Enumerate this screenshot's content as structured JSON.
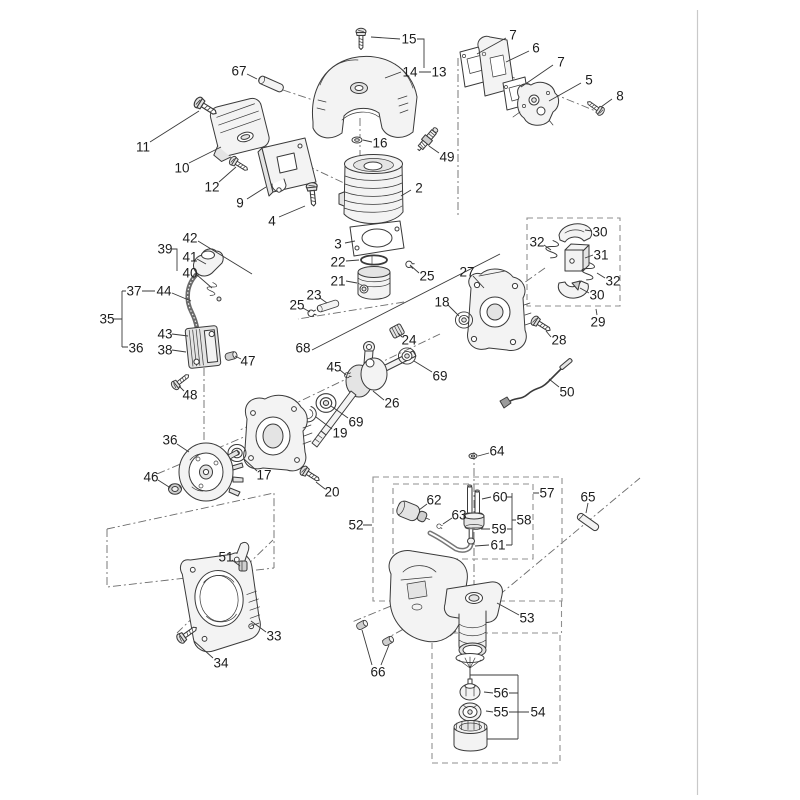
{
  "page": {
    "background": "#ffffff",
    "ink_color": "#3a3a3a",
    "dashed_group_color": "#8f8f8f",
    "rule_color": "#c9c9c9"
  },
  "diagram": {
    "kind": "exploded-parts-diagram",
    "dashed_groups": [
      "29",
      "52",
      "57",
      "54"
    ],
    "labels": [
      {
        "n": "15",
        "x": 409,
        "y": 39
      },
      {
        "n": "14",
        "x": 410,
        "y": 72
      },
      {
        "n": "13",
        "x": 439,
        "y": 72
      },
      {
        "n": "67",
        "x": 239,
        "y": 71
      },
      {
        "n": "11",
        "x": 143,
        "y": 147
      },
      {
        "n": "10",
        "x": 182,
        "y": 168
      },
      {
        "n": "12",
        "x": 212,
        "y": 187
      },
      {
        "n": "9",
        "x": 240,
        "y": 203
      },
      {
        "n": "4",
        "x": 272,
        "y": 221
      },
      {
        "n": "16",
        "x": 380,
        "y": 143
      },
      {
        "n": "49",
        "x": 447,
        "y": 157
      },
      {
        "n": "2",
        "x": 419,
        "y": 188
      },
      {
        "n": "3",
        "x": 338,
        "y": 244
      },
      {
        "n": "22",
        "x": 338,
        "y": 262
      },
      {
        "n": "21",
        "x": 338,
        "y": 281
      },
      {
        "n": "23",
        "x": 314,
        "y": 295
      },
      {
        "n": "25",
        "x": 297,
        "y": 305
      },
      {
        "n": "25",
        "x": 427,
        "y": 276
      },
      {
        "n": "7",
        "x": 513,
        "y": 35
      },
      {
        "n": "6",
        "x": 536,
        "y": 48
      },
      {
        "n": "7",
        "x": 561,
        "y": 62
      },
      {
        "n": "5",
        "x": 589,
        "y": 80
      },
      {
        "n": "8",
        "x": 620,
        "y": 96
      },
      {
        "n": "27",
        "x": 467,
        "y": 272
      },
      {
        "n": "18",
        "x": 442,
        "y": 302
      },
      {
        "n": "28",
        "x": 559,
        "y": 340
      },
      {
        "n": "29",
        "x": 598,
        "y": 322
      },
      {
        "n": "30",
        "x": 600,
        "y": 232
      },
      {
        "n": "31",
        "x": 601,
        "y": 255
      },
      {
        "n": "32",
        "x": 537,
        "y": 242
      },
      {
        "n": "32",
        "x": 613,
        "y": 281
      },
      {
        "n": "30",
        "x": 597,
        "y": 295
      },
      {
        "n": "50",
        "x": 567,
        "y": 392
      },
      {
        "n": "68",
        "x": 303,
        "y": 348
      },
      {
        "n": "45",
        "x": 334,
        "y": 367
      },
      {
        "n": "26",
        "x": 392,
        "y": 403
      },
      {
        "n": "24",
        "x": 409,
        "y": 340
      },
      {
        "n": "69",
        "x": 440,
        "y": 376
      },
      {
        "n": "69",
        "x": 356,
        "y": 422
      },
      {
        "n": "19",
        "x": 340,
        "y": 433
      },
      {
        "n": "17",
        "x": 264,
        "y": 475
      },
      {
        "n": "36",
        "x": 170,
        "y": 440
      },
      {
        "n": "46",
        "x": 151,
        "y": 477
      },
      {
        "n": "20",
        "x": 332,
        "y": 492
      },
      {
        "n": "47",
        "x": 248,
        "y": 361
      },
      {
        "n": "48",
        "x": 190,
        "y": 395
      },
      {
        "n": "35",
        "x": 107,
        "y": 319
      },
      {
        "n": "37",
        "x": 134,
        "y": 291
      },
      {
        "n": "44",
        "x": 164,
        "y": 291
      },
      {
        "n": "39",
        "x": 165,
        "y": 249
      },
      {
        "n": "41",
        "x": 190,
        "y": 257
      },
      {
        "n": "40",
        "x": 190,
        "y": 273
      },
      {
        "n": "42",
        "x": 190,
        "y": 238
      },
      {
        "n": "43",
        "x": 165,
        "y": 334
      },
      {
        "n": "38",
        "x": 165,
        "y": 350
      },
      {
        "n": "36",
        "x": 136,
        "y": 348
      },
      {
        "n": "51",
        "x": 226,
        "y": 557
      },
      {
        "n": "33",
        "x": 274,
        "y": 636
      },
      {
        "n": "34",
        "x": 221,
        "y": 663
      },
      {
        "n": "66",
        "x": 378,
        "y": 672
      },
      {
        "n": "52",
        "x": 356,
        "y": 525
      },
      {
        "n": "57",
        "x": 547,
        "y": 493
      },
      {
        "n": "62",
        "x": 434,
        "y": 500
      },
      {
        "n": "63",
        "x": 459,
        "y": 515
      },
      {
        "n": "60",
        "x": 500,
        "y": 497
      },
      {
        "n": "59",
        "x": 499,
        "y": 529
      },
      {
        "n": "61",
        "x": 498,
        "y": 545
      },
      {
        "n": "58",
        "x": 524,
        "y": 520
      },
      {
        "n": "64",
        "x": 497,
        "y": 451
      },
      {
        "n": "65",
        "x": 588,
        "y": 497
      },
      {
        "n": "53",
        "x": 527,
        "y": 618
      },
      {
        "n": "56",
        "x": 501,
        "y": 693
      },
      {
        "n": "55",
        "x": 501,
        "y": 712
      },
      {
        "n": "54",
        "x": 538,
        "y": 712
      }
    ]
  }
}
